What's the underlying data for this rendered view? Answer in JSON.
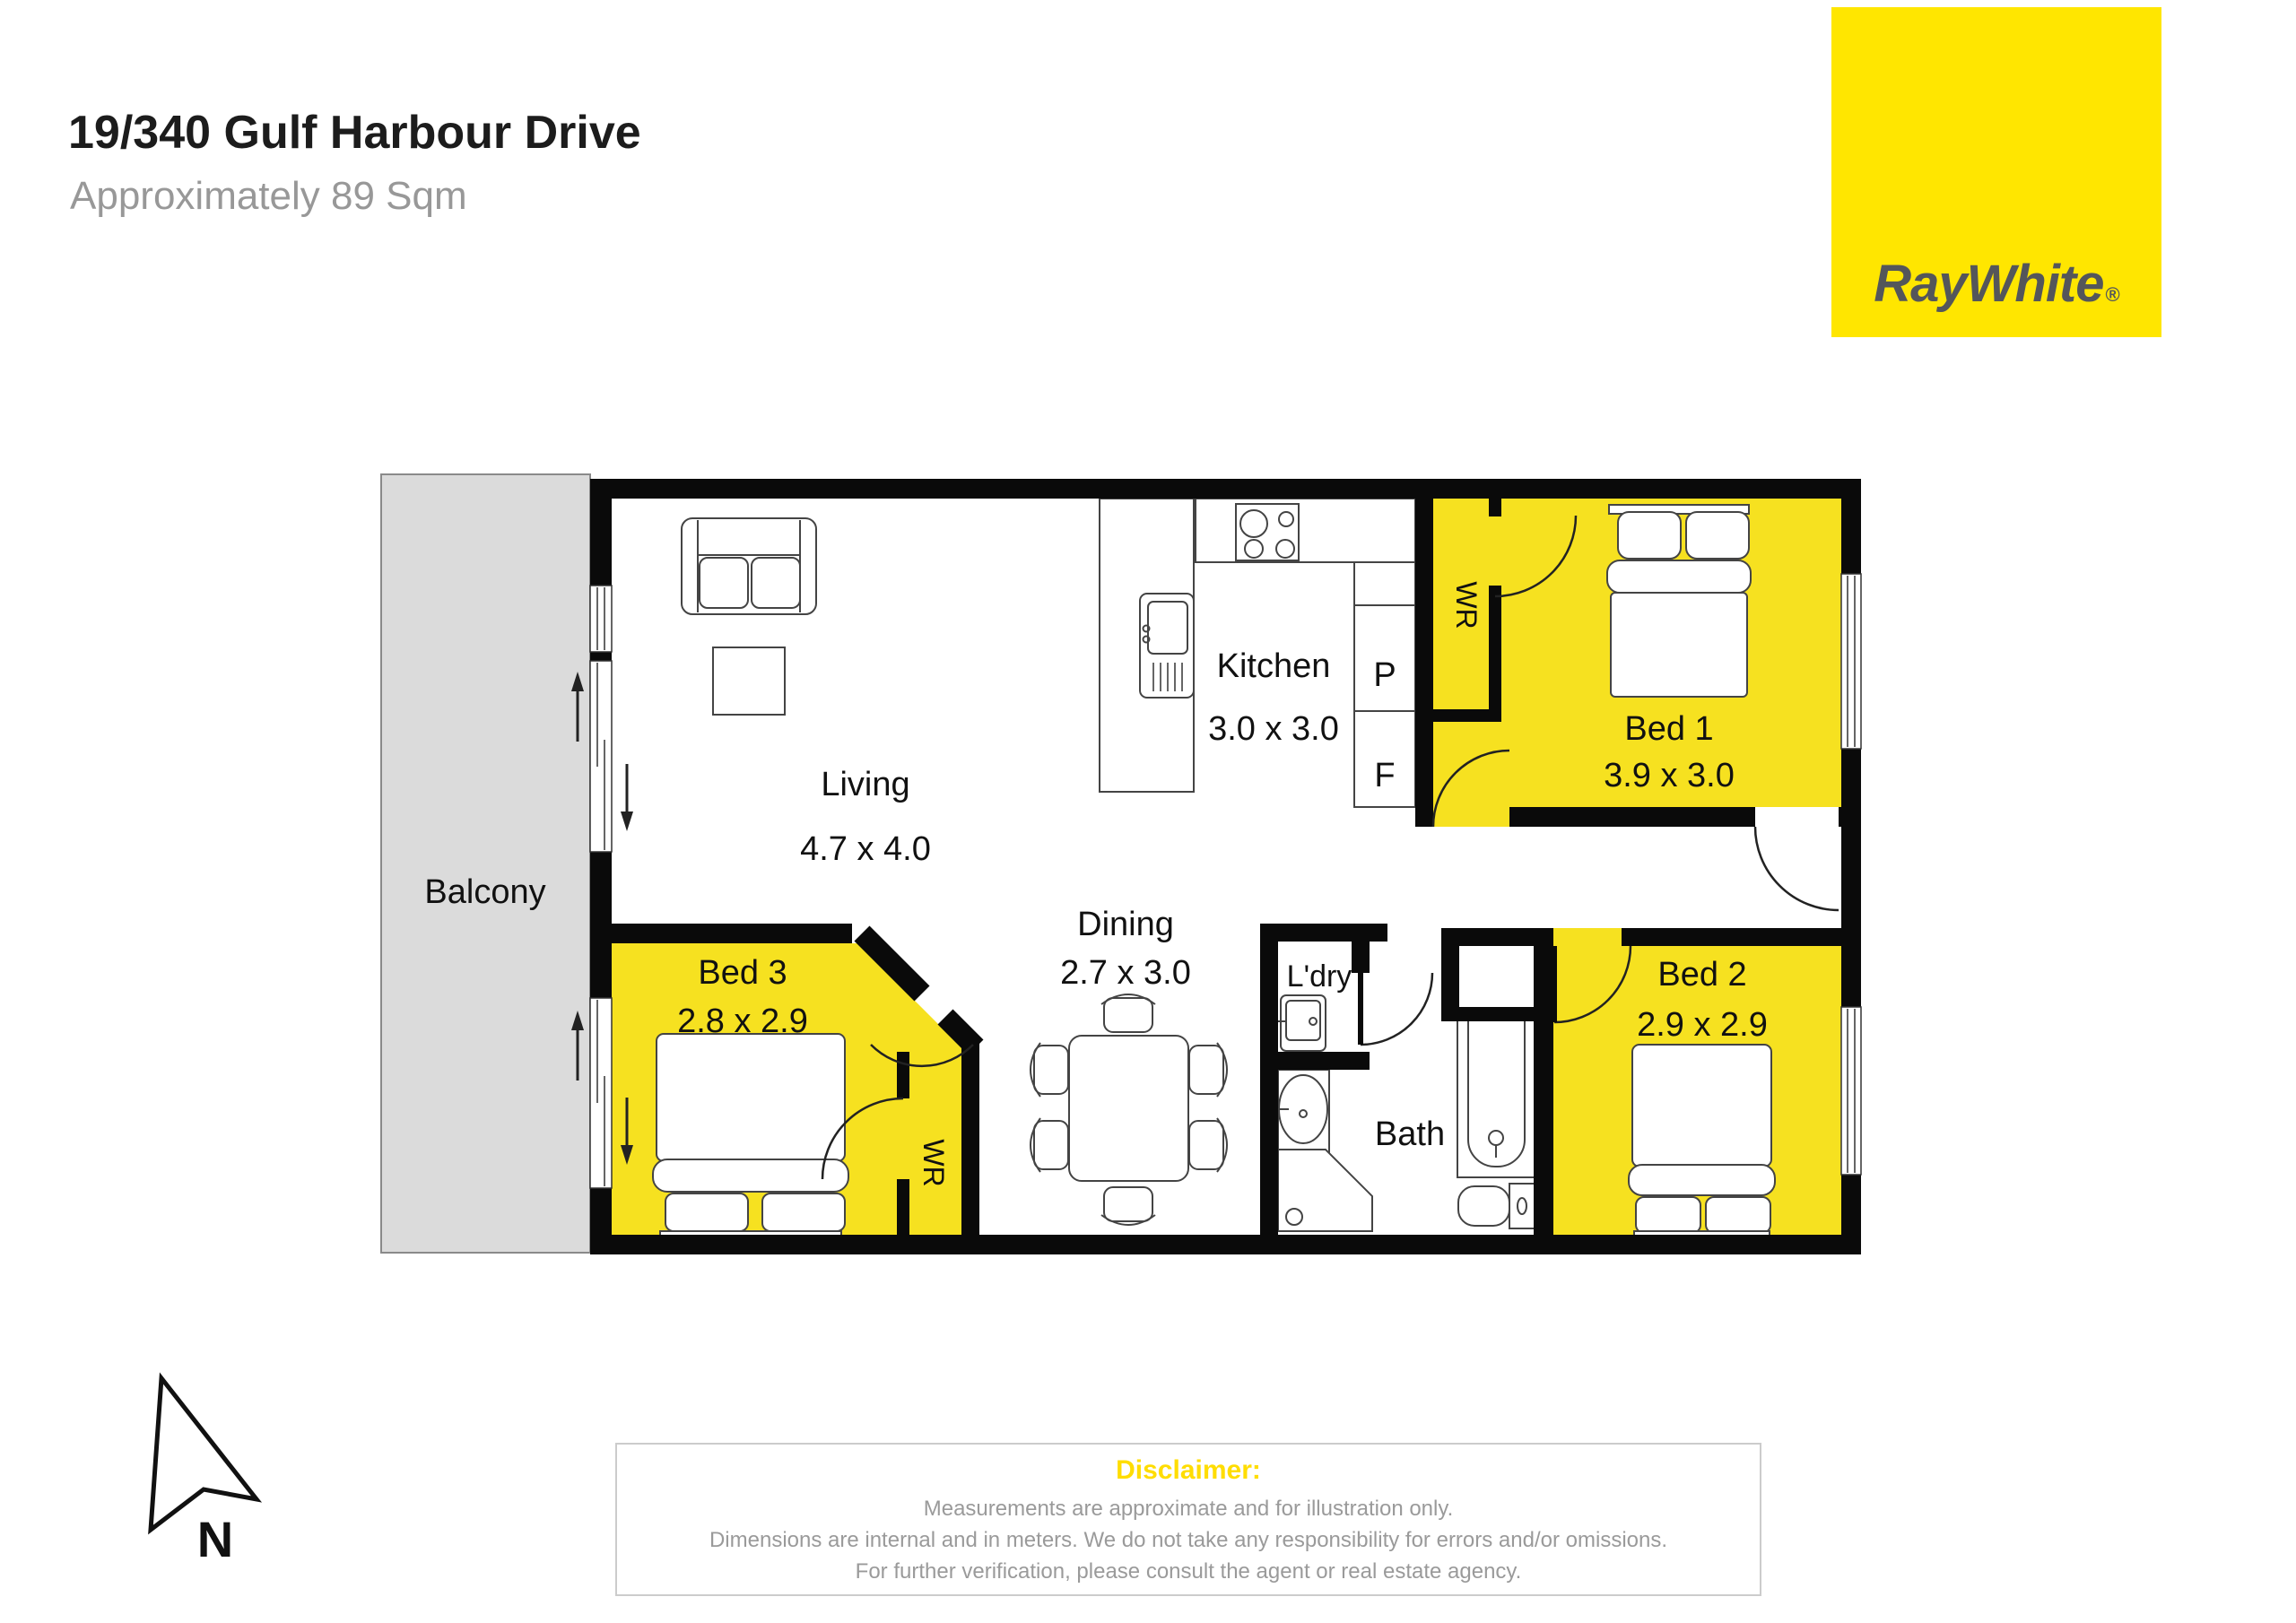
{
  "header": {
    "title": "19/340 Gulf Harbour Drive",
    "subtitle": "Approximately 89 Sqm"
  },
  "logo": {
    "brand": "RayWhite",
    "registered_mark": "®"
  },
  "compass": {
    "north_label": "N"
  },
  "floorplan": {
    "balcony": {
      "name": "Balcony"
    },
    "living": {
      "name": "Living",
      "dims": "4.7 x 4.0"
    },
    "kitchen": {
      "name": "Kitchen",
      "dims": "3.0 x 3.0",
      "pantry_label": "P",
      "fridge_label": "F"
    },
    "bed1": {
      "name": "Bed 1",
      "dims": "3.9 x 3.0",
      "wardrobe_label": "WR"
    },
    "bed2": {
      "name": "Bed 2",
      "dims": "2.9 x 2.9"
    },
    "bed3": {
      "name": "Bed 3",
      "dims": "2.8 x 2.9",
      "wardrobe_label": "WR"
    },
    "dining": {
      "name": "Dining",
      "dims": "2.7 x 3.0"
    },
    "laundry": {
      "name": "L'dry"
    },
    "bath": {
      "name": "Bath"
    }
  },
  "disclaimer": {
    "heading": "Disclaimer:",
    "lines": [
      "Measurements are approximate and for illustration only.",
      "Dimensions are internal and in meters. We do not take any responsibility for errors and/or omissions.",
      "For further verification, please consult the agent or real estate agency."
    ]
  },
  "colors": {
    "brand_yellow": "#FFE600",
    "room_yellow": "#F6E120",
    "balcony_gray": "#DBDBDB",
    "logo_text_gray": "#54565A",
    "disclaimer_heading_yellow": "#FFDD00",
    "body_text_gray": "#9A9A9A",
    "wall_black": "#0A0A0A"
  }
}
